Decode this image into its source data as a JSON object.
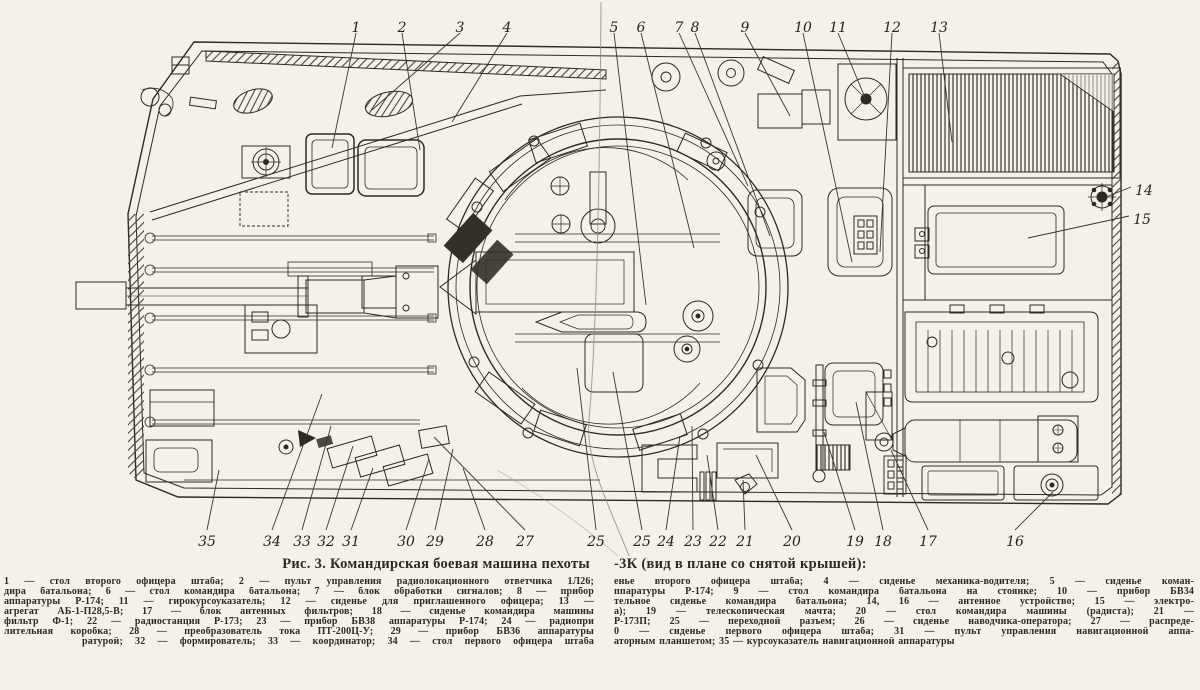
{
  "colors": {
    "paper": "#f3f1e9",
    "ink": "#2d2a25",
    "fold": "#938c7c"
  },
  "caption": {
    "title_left": "Рис. 3. Командирская боевая машина пехоты",
    "title_right": "-3К (вид в плане со снятой крышей):",
    "legend_rows": [
      {
        "left": "1 — стол второго офицера штаба; 2 — пульт управления радиолокационного ответчика 1Л26;",
        "right": "енье второго офицера штаба; 4 — сиденье механика-водителя; 5 — сиденье коман-"
      },
      {
        "left": "дира батальона; 6 — стол командира батальона; 7 — блок обработки сигналов; 8 — прибор",
        "right": "ппаратуры Р-174; 9 — стол командира батальона на стоянке; 10 — прибор БВ34"
      },
      {
        "left": "аппаратуры Р-174; 11 — гирокурсоуказатель; 12 — сиденье для приглашенного офицера; 13 —",
        "right": "тельное сиденье командира батальона; 14, 16 — антенное устройство; 15 — электро-"
      },
      {
        "left": "агрегат АБ-1-П28,5-В; 17 — блок антенных фильтров; 18 — сиденье командира машины",
        "right": "а); 19 — телескопическая мачта; 20 — стол командира машины (радиста); 21 —"
      },
      {
        "left": "фильтр Ф-1; 22 — радиостанция Р-173; 23 — прибор БВ38 аппаратуры Р-174; 24 — радиопри",
        "right": "Р-173П; 25 — переходной разъем; 26 — сиденье наводчика-оператора; 27 — распреде-"
      },
      {
        "left": "лительная коробка; 28 — преобразователь тока ПТ-200Ц-У; 29 — прибор БВ36 аппаратуры",
        "right": "0 — сиденье первого офицера штаба; 31 — пульт управления навигационной аппа-"
      },
      {
        "left": "ратурой; 32 — формирователь; 33 — координатор; 34 — стол первого офицера штаба",
        "right": "аторным планшетом; 35 — курсоуказатель навигационной аппаратуры"
      }
    ]
  },
  "callouts": [
    {
      "label": "1",
      "x": 356,
      "y": 27,
      "tx": 332,
      "ty": 148
    },
    {
      "label": "2",
      "x": 402,
      "y": 27,
      "tx": 420,
      "ty": 150
    },
    {
      "label": "3",
      "x": 460,
      "y": 27,
      "tx": 372,
      "ty": 110
    },
    {
      "label": "4",
      "x": 507,
      "y": 27,
      "tx": 452,
      "ty": 122
    },
    {
      "label": "5",
      "x": 614,
      "y": 27,
      "tx": 646,
      "ty": 305
    },
    {
      "label": "6",
      "x": 641,
      "y": 27,
      "tx": 694,
      "ty": 248
    },
    {
      "label": "7",
      "x": 679,
      "y": 27,
      "tx": 748,
      "ty": 186
    },
    {
      "label": "8",
      "x": 695,
      "y": 27,
      "tx": 770,
      "ty": 236
    },
    {
      "label": "9",
      "x": 745,
      "y": 27,
      "tx": 790,
      "ty": 116
    },
    {
      "label": "10",
      "x": 803,
      "y": 27,
      "tx": 852,
      "ty": 262
    },
    {
      "label": "11",
      "x": 838,
      "y": 27,
      "tx": 866,
      "ty": 100
    },
    {
      "label": "12",
      "x": 892,
      "y": 27,
      "tx": 880,
      "ty": 252
    },
    {
      "label": "13",
      "x": 939,
      "y": 27,
      "tx": 952,
      "ty": 142
    },
    {
      "label": "14",
      "x": 1144,
      "y": 190,
      "tx": 1106,
      "ty": 197
    },
    {
      "label": "15",
      "x": 1142,
      "y": 219,
      "tx": 1028,
      "ty": 238
    },
    {
      "label": "16",
      "x": 1015,
      "y": 541,
      "tx": 1053,
      "ty": 492
    },
    {
      "label": "17",
      "x": 928,
      "y": 541,
      "tx": 891,
      "ty": 450
    },
    {
      "label": "18",
      "x": 883,
      "y": 541,
      "tx": 856,
      "ty": 402
    },
    {
      "label": "19",
      "x": 855,
      "y": 541,
      "tx": 824,
      "ty": 432
    },
    {
      "label": "20",
      "x": 792,
      "y": 541,
      "tx": 756,
      "ty": 455
    },
    {
      "label": "21",
      "x": 745,
      "y": 541,
      "tx": 743,
      "ty": 480
    },
    {
      "label": "22",
      "x": 718,
      "y": 541,
      "tx": 707,
      "ty": 455
    },
    {
      "label": "23",
      "x": 693,
      "y": 541,
      "tx": 692,
      "ty": 426
    },
    {
      "label": "24",
      "x": 666,
      "y": 541,
      "tx": 680,
      "ty": 436
    },
    {
      "label": "25",
      "x": 642,
      "y": 541,
      "tx": 613,
      "ty": 372
    },
    {
      "label": "25",
      "x": 596,
      "y": 541,
      "tx": 577,
      "ty": 368
    },
    {
      "label": "27",
      "x": 525,
      "y": 541,
      "tx": 434,
      "ty": 437
    },
    {
      "label": "28",
      "x": 485,
      "y": 541,
      "tx": 463,
      "ty": 468
    },
    {
      "label": "29",
      "x": 435,
      "y": 541,
      "tx": 453,
      "ty": 449
    },
    {
      "label": "30",
      "x": 406,
      "y": 541,
      "tx": 429,
      "ty": 459
    },
    {
      "label": "31",
      "x": 351,
      "y": 541,
      "tx": 373,
      "ty": 468
    },
    {
      "label": "32",
      "x": 326,
      "y": 541,
      "tx": 353,
      "ty": 446
    },
    {
      "label": "33",
      "x": 302,
      "y": 541,
      "tx": 331,
      "ty": 426
    },
    {
      "label": "34",
      "x": 272,
      "y": 541,
      "tx": 322,
      "ty": 394
    },
    {
      "label": "35",
      "x": 207,
      "y": 541,
      "tx": 219,
      "ty": 470
    }
  ]
}
